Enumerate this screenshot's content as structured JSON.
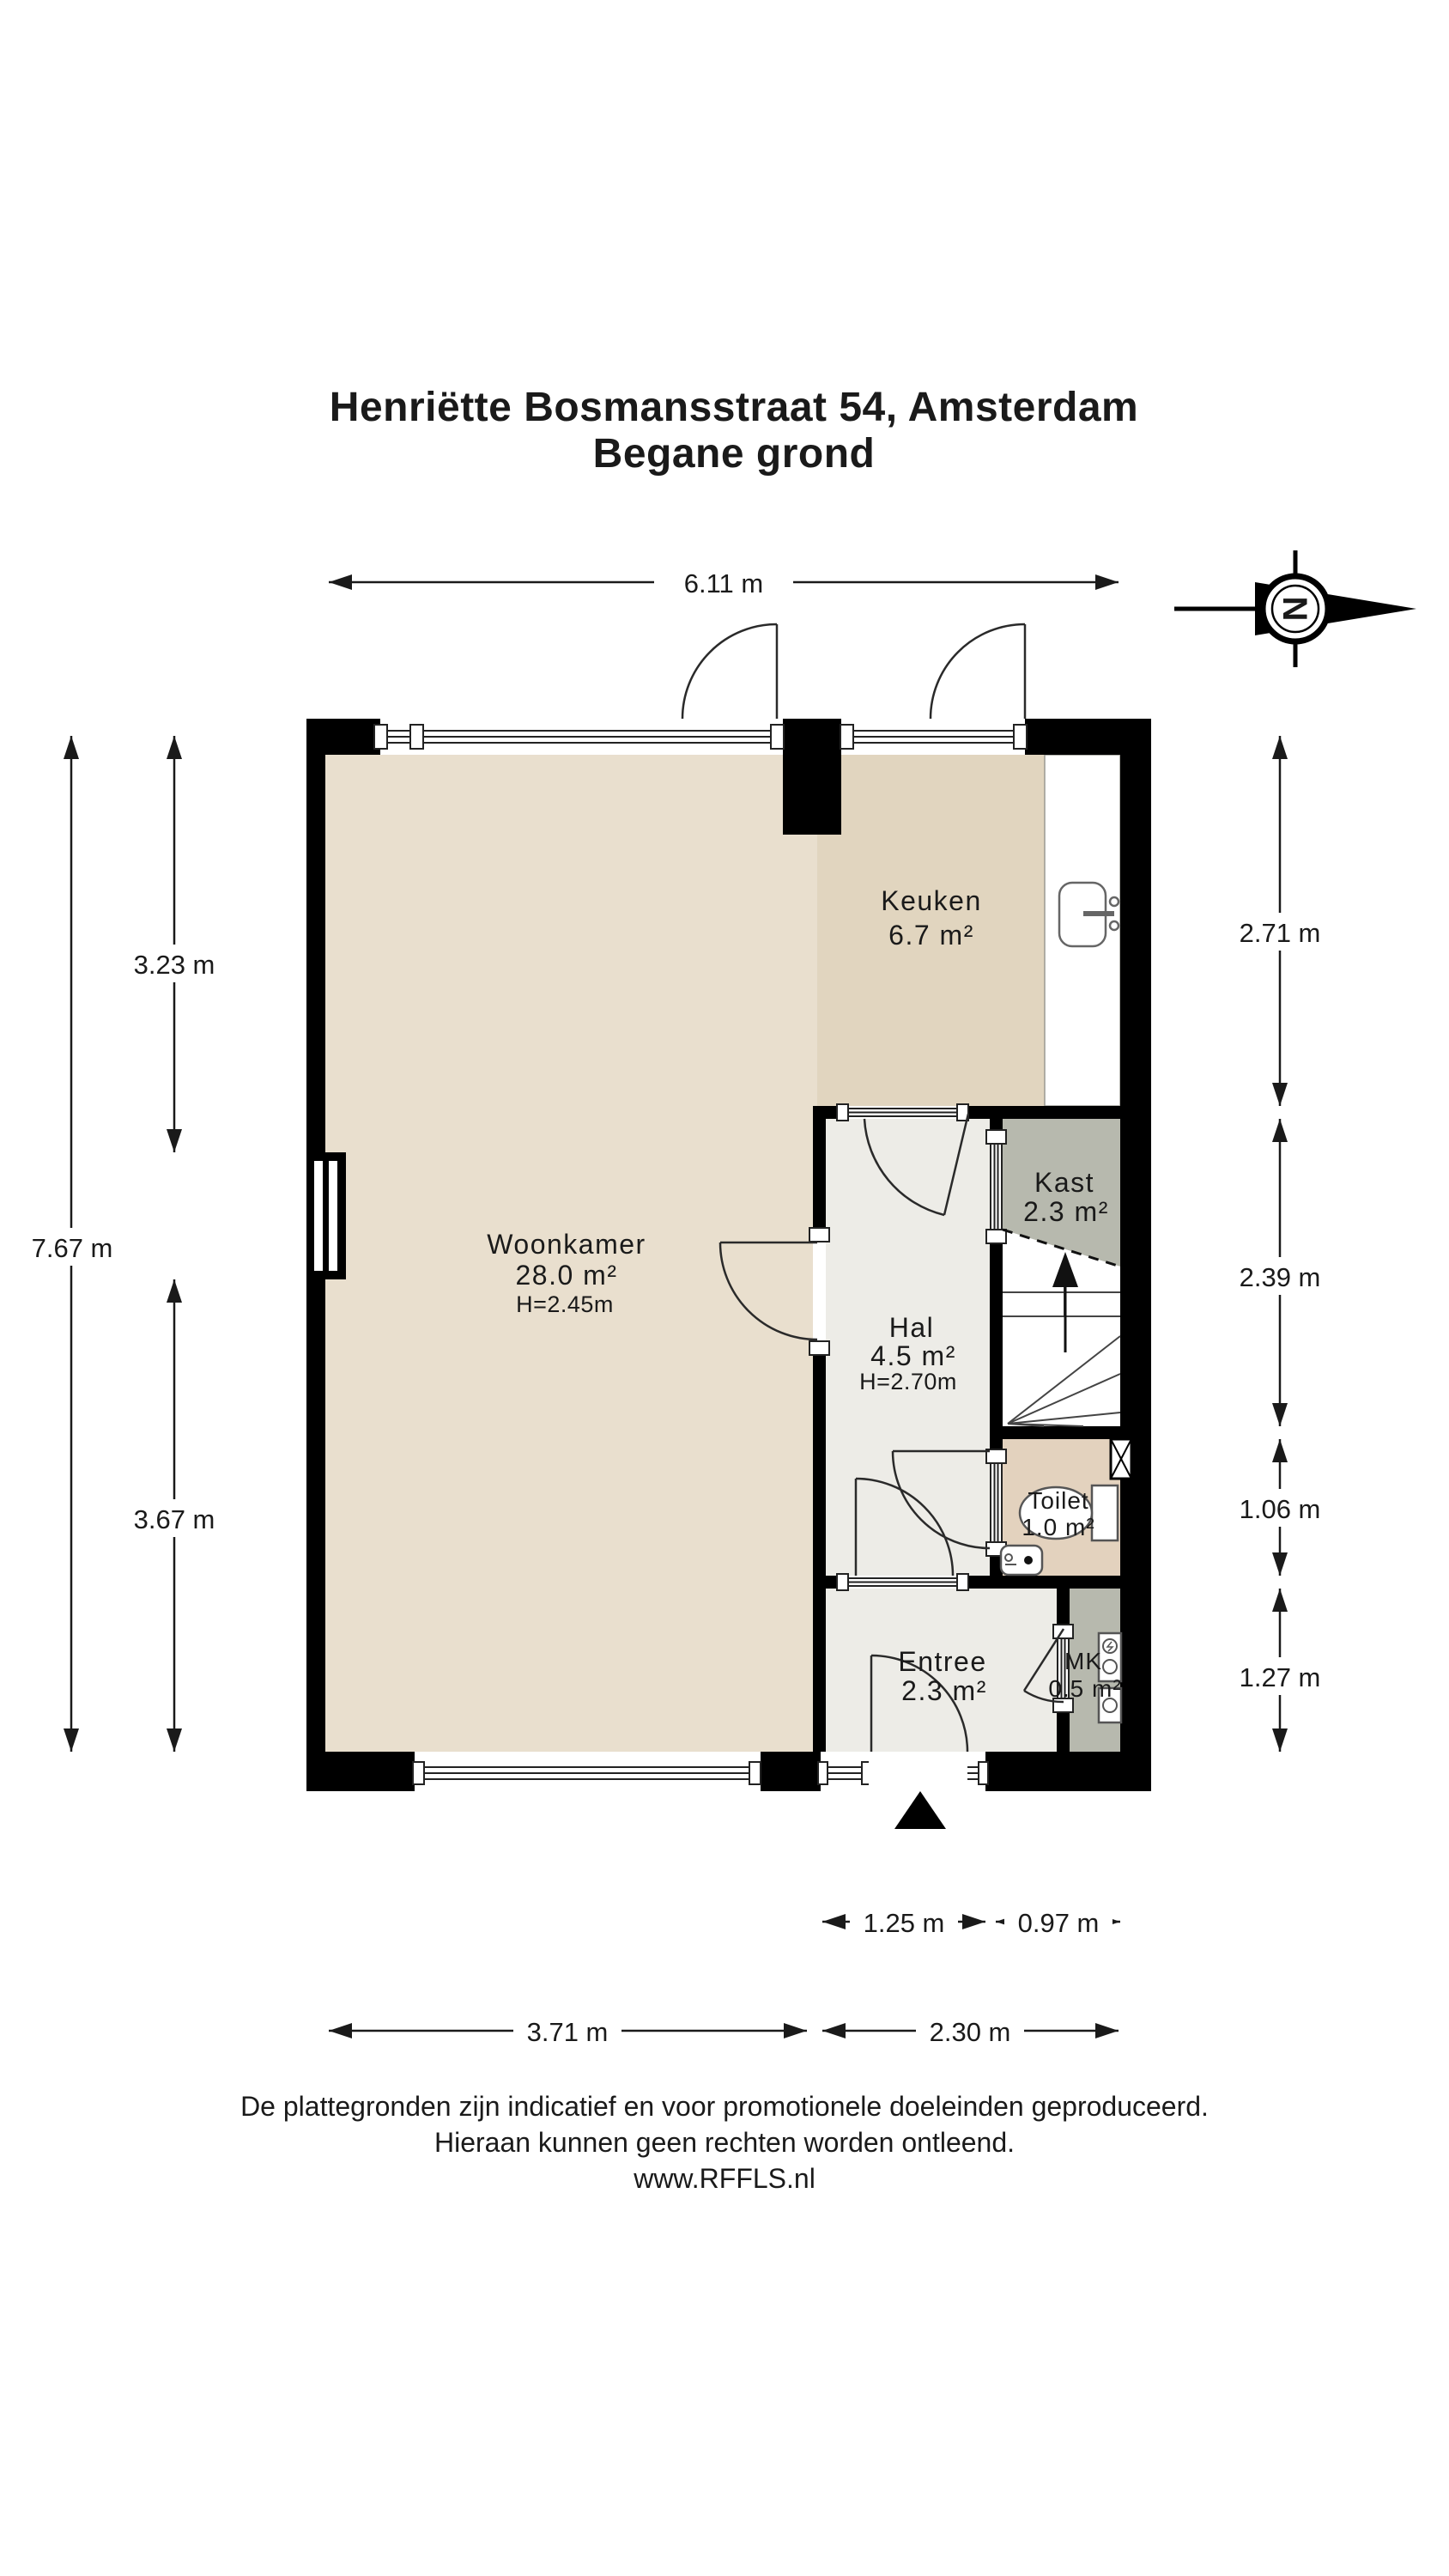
{
  "title": {
    "line1": "Henriëtte Bosmansstraat 54, Amsterdam",
    "line2": "Begane grond"
  },
  "compass": {
    "letter": "N"
  },
  "rooms": {
    "woonkamer": {
      "name": "Woonkamer",
      "area": "28.0 m²",
      "ceiling": "H=2.45m"
    },
    "keuken": {
      "name": "Keuken",
      "area": "6.7 m²"
    },
    "kast": {
      "name": "Kast",
      "area": "2.3 m²"
    },
    "hal": {
      "name": "Hal",
      "area": "4.5 m²",
      "ceiling": "H=2.70m"
    },
    "toilet": {
      "name": "Toilet",
      "area": "1.0 m²"
    },
    "entree": {
      "name": "Entree",
      "area": "2.3 m²"
    },
    "mk": {
      "name": "MK",
      "area": "0.5 m²"
    }
  },
  "dimensions": {
    "top_width": "6.11 m",
    "left_total": "7.67 m",
    "left_upper": "3.23 m",
    "left_lower": "3.67 m",
    "right_keuken": "2.71 m",
    "right_stairs": "2.39 m",
    "right_toilet": "1.06 m",
    "right_entree": "1.27 m",
    "bottom_entree": "1.25 m",
    "bottom_mk": "0.97 m",
    "bottom_woonkamer": "3.71 m",
    "bottom_right": "2.30 m"
  },
  "footer": {
    "line1": "De plattegronden zijn indicatief en voor promotionele doeleinden geproduceerd.",
    "line2": "Hieraan kunnen geen rechten worden ontleend.",
    "line3": "www.RFFLS.nl"
  },
  "colors": {
    "woonkamer": "#e9dfce",
    "keuken": "#e1d5bf",
    "hal": "#edece7",
    "entree": "#edece7",
    "toilet": "#e3d2be",
    "kast": "#b7b9ae",
    "mk": "#b7b9ae",
    "stairs": "#ffffff",
    "wall": "#000000",
    "paper": "#ffffff"
  }
}
